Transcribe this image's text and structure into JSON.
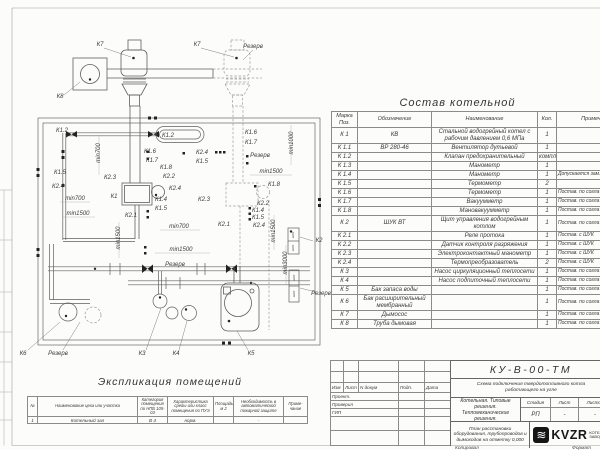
{
  "accent_colors": {
    "line": "#5f5f5f",
    "paper": "#fcfcfa",
    "logo_bg": "#151515"
  },
  "plan": {
    "labels": [
      {
        "t": "К7",
        "x": 100,
        "y": 45
      },
      {
        "t": "К7",
        "x": 197,
        "y": 45
      },
      {
        "t": "Резерв",
        "x": 253,
        "y": 47
      },
      {
        "t": "К8",
        "x": 60,
        "y": 97
      },
      {
        "t": "К1.2",
        "x": 62,
        "y": 131
      },
      {
        "t": "min700",
        "x": 99,
        "y": 153,
        "r": 1
      },
      {
        "t": "К1.2",
        "x": 168,
        "y": 136
      },
      {
        "t": "К1.6",
        "x": 150,
        "y": 152
      },
      {
        "t": "К1.7",
        "x": 152,
        "y": 161
      },
      {
        "t": "К2.4",
        "x": 202,
        "y": 153
      },
      {
        "t": "К1.5",
        "x": 202,
        "y": 162
      },
      {
        "t": "К1.6",
        "x": 251,
        "y": 133
      },
      {
        "t": "К1.7",
        "x": 251,
        "y": 143
      },
      {
        "t": "Резерв",
        "x": 260,
        "y": 156
      },
      {
        "t": "min1000",
        "x": 292,
        "y": 143,
        "r": 1
      },
      {
        "t": "К1.5",
        "x": 60,
        "y": 173
      },
      {
        "t": "К2.4",
        "x": 58,
        "y": 187
      },
      {
        "t": "К2.3",
        "x": 110,
        "y": 178
      },
      {
        "t": "К1.8",
        "x": 166,
        "y": 168
      },
      {
        "t": "К2.2",
        "x": 169,
        "y": 177
      },
      {
        "t": "min1500",
        "x": 271,
        "y": 172
      },
      {
        "t": "К1.8",
        "x": 274,
        "y": 185
      },
      {
        "t": "min700",
        "x": 75,
        "y": 199
      },
      {
        "t": "К1",
        "x": 114,
        "y": 197
      },
      {
        "t": "К2.4",
        "x": 175,
        "y": 189
      },
      {
        "t": "К1.4",
        "x": 161,
        "y": 200
      },
      {
        "t": "К1.5",
        "x": 161,
        "y": 209
      },
      {
        "t": "К2.3",
        "x": 204,
        "y": 200
      },
      {
        "t": "К2.2",
        "x": 263,
        "y": 204
      },
      {
        "t": "К1.4",
        "x": 258,
        "y": 211
      },
      {
        "t": "К1.5",
        "x": 258,
        "y": 218
      },
      {
        "t": "К2.4",
        "x": 259,
        "y": 226
      },
      {
        "t": "min1500",
        "x": 78,
        "y": 214
      },
      {
        "t": "К2.1",
        "x": 131,
        "y": 216
      },
      {
        "t": "min700",
        "x": 179,
        "y": 227
      },
      {
        "t": "К2.1",
        "x": 224,
        "y": 225
      },
      {
        "t": "min1500",
        "x": 119,
        "y": 238,
        "r": 1
      },
      {
        "t": "min1500",
        "x": 274,
        "y": 231,
        "r": 1
      },
      {
        "t": "min3000",
        "x": 286,
        "y": 263,
        "r": 1
      },
      {
        "t": "min1500",
        "x": 181,
        "y": 250
      },
      {
        "t": "Резерв",
        "x": 175,
        "y": 265
      },
      {
        "t": "К2",
        "x": 319,
        "y": 241
      },
      {
        "t": "Резерв",
        "x": 321,
        "y": 294
      },
      {
        "t": "К6",
        "x": 23,
        "y": 354
      },
      {
        "t": "Резерв",
        "x": 58,
        "y": 354
      },
      {
        "t": "К3",
        "x": 142,
        "y": 354
      },
      {
        "t": "К4",
        "x": 176,
        "y": 354
      },
      {
        "t": "К5",
        "x": 251,
        "y": 354
      },
      {
        "t": "ШУК",
        "x": 293,
        "y": 235,
        "r": 1,
        "fs": 3
      },
      {
        "t": "ШУК",
        "x": 293,
        "y": 248,
        "r": 1,
        "fs": 3
      },
      {
        "t": "ШУК",
        "x": 294,
        "y": 278,
        "r": 1,
        "fs": 3
      },
      {
        "t": "ШУК",
        "x": 294,
        "y": 294,
        "r": 1,
        "fs": 3
      }
    ]
  },
  "sostav": {
    "title": "Состав котельной",
    "headers": [
      "Марка Поз.",
      "Обозначение",
      "Наименование",
      "Кол.",
      "Примечание"
    ],
    "rows": [
      [
        "К 1",
        "КВ",
        "Стальной водогрейный котел с рабочим давлением 0,6 МПа",
        "1",
        ""
      ],
      [
        "К 1.1",
        "ВР 280-46",
        "Вентилятор дутьевой",
        "1",
        ""
      ],
      [
        "К 1.2",
        "",
        "Клапан предохранительный",
        "компл.",
        ""
      ],
      [
        "К 1.3",
        "",
        "Манометр",
        "1",
        ""
      ],
      [
        "К 1.4",
        "",
        "Манометр",
        "1",
        "Допускается зам. поз. К 2.3"
      ],
      [
        "К 1.5",
        "",
        "Термометр",
        "2",
        ""
      ],
      [
        "К 1.6",
        "",
        "Термометр",
        "1",
        "Постав. по согла"
      ],
      [
        "К 1.7",
        "",
        "Вакуумметр",
        "1",
        "Постав. по согла"
      ],
      [
        "К 1.8",
        "",
        "Мановакуумметр",
        "1",
        "Постав. по согла"
      ],
      [
        "К 2",
        "ШУК ВТ",
        "Щит управления водогрейным котлом",
        "1",
        "Постав. по согла"
      ],
      [
        "К 2.1",
        "",
        "Реле протока",
        "1",
        "Постав. с ШУК"
      ],
      [
        "К 2.2",
        "",
        "Датчик контроля разряжения",
        "1",
        "Постав. с ШУК"
      ],
      [
        "К 2.3",
        "",
        "Электроконтактный манометр",
        "1",
        "Постав. с ШУК"
      ],
      [
        "К 2.4",
        "",
        "Термопреобразователь",
        "2",
        "Постав. с ШУК"
      ],
      [
        "К 3",
        "",
        "Насос циркуляционный теплосети",
        "1",
        "Постав. по согла"
      ],
      [
        "К 4",
        "",
        "Насос подпиточный теплосети",
        "1",
        "Постав. по согла"
      ],
      [
        "К 5",
        "Бак запаса воды",
        "",
        "1",
        "Постав. по согла"
      ],
      [
        "К 6",
        "Бак расширительный мембранный",
        "",
        "1",
        "Постав. по согла"
      ],
      [
        "К 7",
        "Дымосос",
        "",
        "1",
        "Постав. по согла"
      ],
      [
        "К 8",
        "Труба дымовая",
        "",
        "1",
        "Постав. по согла"
      ]
    ]
  },
  "explication": {
    "title": "Экспликация помещений",
    "headers": [
      "№",
      "Наименование цеха или участка",
      "Категория помещения по НПБ 105-03",
      "Характеристика среды или класс помещения по ПУЭ",
      "Площадь, м 2",
      "Необходимость в автоматической пожарной защите",
      "Приме- чание"
    ],
    "rows": [
      [
        "1",
        "Котельный зал",
        "В 4",
        "норм.",
        "",
        "-",
        ""
      ]
    ]
  },
  "titleblock": {
    "doc_number": "КУ-В-00-ТМ",
    "subtitle": "Схема подключения твердотопливного котла работающего на угле",
    "sig_headers": [
      "Изм",
      "Лист",
      "N докум",
      "Подп.",
      "Дата"
    ],
    "sig_names": [
      "Проект.",
      "Проверил",
      "ГИП"
    ],
    "object": "Котельная. Типовые решения. Тепломеханические решения.",
    "stage_headers": [
      "Стадия",
      "Лист",
      "Листов"
    ],
    "stage_values": [
      "РП",
      "-",
      "-"
    ],
    "sheet_title": "План расстановки оборудования, трубопроводов и дымоходов на отметку 0,000",
    "logo_glyph": "≋",
    "logo_word": "KVZR",
    "logo_sub1": "КОТЕЛЬНЫ",
    "logo_sub2": "ЗАВОД Р",
    "copied_label": "Копировал",
    "format_label": "Формат"
  }
}
